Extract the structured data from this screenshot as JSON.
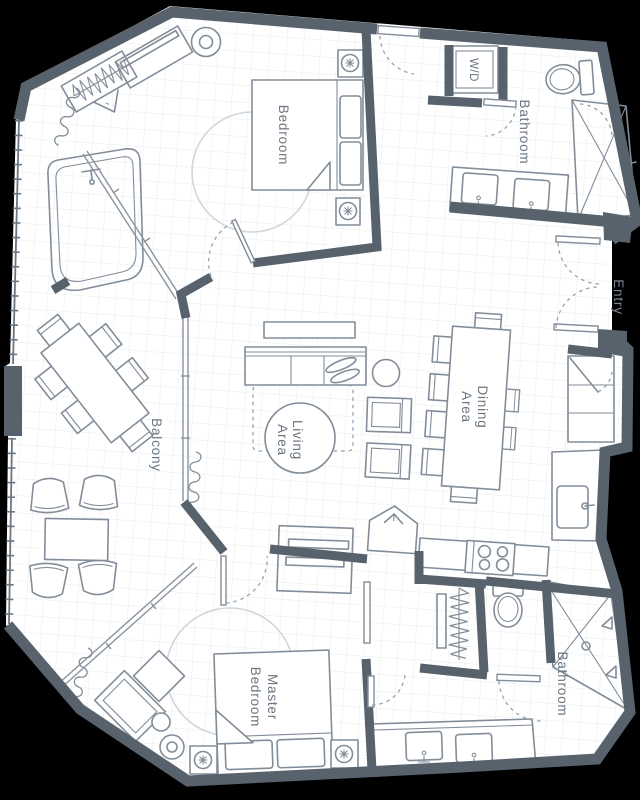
{
  "title": "Apartment Floor Plan",
  "colors": {
    "bg": "#000000",
    "floor": "#ffffff",
    "grid": "#e9eced",
    "wall": "#57626d",
    "furniture": "#828d99",
    "light": "#d0d6db",
    "label": "#6a7580",
    "labelOnBlack": "#7b8592",
    "dash": "#98a1ac",
    "glass": "#8a939e"
  },
  "labels": {
    "bedroom": "Bedroom",
    "bathroom_top": "Bathroom",
    "wd": "W/D",
    "entry": "Entry",
    "dining": {
      "line1": "Dining",
      "line2": "Area"
    },
    "living": {
      "line1": "Living",
      "line2": "Area"
    },
    "balcony": "Balcony",
    "master": {
      "line1": "Master",
      "line2": "Bedroom"
    },
    "bathroom_bottom": "Bathroom"
  }
}
